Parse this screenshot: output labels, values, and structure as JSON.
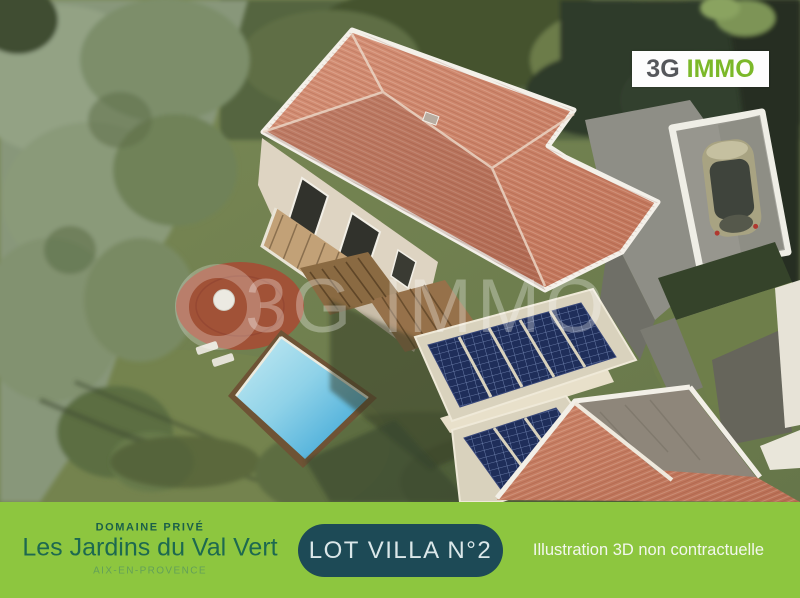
{
  "brand": {
    "logo_text_dark": "3G",
    "logo_text_green": "IMMO",
    "logo_color_dark": "#55575b",
    "logo_color_green": "#7bb829",
    "watermark_text": "3G IMMO"
  },
  "banner": {
    "background_color": "#8dc63f",
    "badge_background_color": "#1d4a56",
    "estate_label": "DOMAINE PRIVÉ",
    "estate_name": "Les Jardins du Val Vert",
    "estate_location": "AIX-EN-PROVENCE",
    "lot_label": "LOT VILLA N°2",
    "disclaimer": "Illustration 3D non contractuelle"
  },
  "scene_colors": {
    "roof_terracotta": "#c87f63",
    "pool_blue": "#35a8d8",
    "grass_green": "#74834e",
    "solar_panel_blue": "#20305e",
    "tree_sage": "#88977a"
  }
}
